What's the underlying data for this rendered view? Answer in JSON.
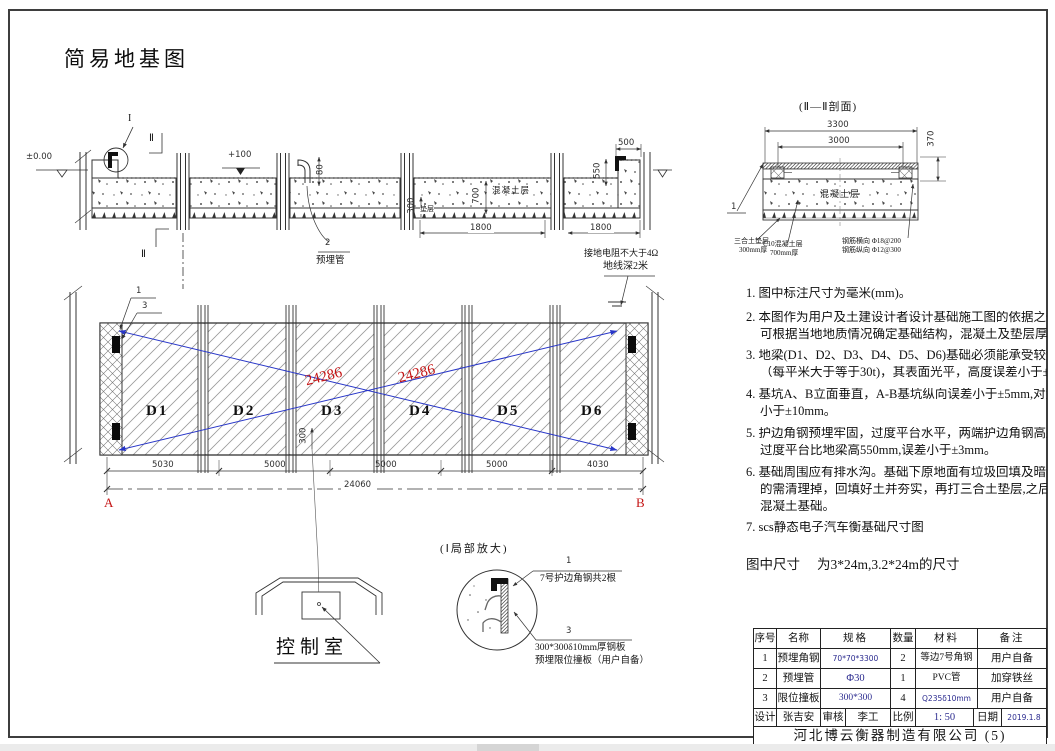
{
  "page": {
    "title": "简易地基图"
  },
  "colors": {
    "dimension_red": "#c41414",
    "diagonal_blue": "#2836c8",
    "spec_navy": "#2b2b8f",
    "line": "#333333"
  },
  "top_section": {
    "marker_i": "I",
    "marker_ii_top": "Ⅱ",
    "marker_ii_bottom": "Ⅱ",
    "level_zero": "±0.00",
    "level_plus100": "+100",
    "dim_pipe": "80",
    "callout_pipe_num": "2",
    "callout_pipe_label": "预埋管",
    "dim_depth": "700",
    "label_concrete": "混凝土层",
    "dim_cushion": "300",
    "label_cushion": "垫层",
    "dim_bay_a": "1800",
    "dim_bay_b": "1800",
    "dim_end_top": "500",
    "dim_end_side": "550",
    "ground_note_l1": "接地电阻不大于4Ω",
    "ground_note_l2": "地线深2米"
  },
  "section_ii": {
    "title": "(Ⅱ—Ⅱ剖面)",
    "dim_total": "3300",
    "dim_inner": "3000",
    "dim_height": "370",
    "callout_num": "1",
    "label_concrete": "混凝土层",
    "leader_cushion_l1": "三合土垫层",
    "leader_cushion_l2": "300mm厚",
    "leader_c10_l1": "C10混凝土层",
    "leader_c10_l2": "700mm厚",
    "leader_rebar_l1": "钢筋横向 Φ18@200",
    "leader_rebar_l2": "钢筋纵向 Φ12@300"
  },
  "plan": {
    "slabs": [
      "D1",
      "D2",
      "D3",
      "D4",
      "D5",
      "D6"
    ],
    "diag_a": "24286",
    "diag_b": "24286",
    "callout_1": "1",
    "callout_3": "3",
    "dim_small": "300",
    "seg_dims": [
      "5030",
      "5000",
      "5000",
      "5000",
      "4030"
    ],
    "dim_total": "24060",
    "corner_a": "A",
    "corner_b": "B"
  },
  "control_room": {
    "label": "控制室"
  },
  "detail_i": {
    "title": "(Ⅰ局部放大)",
    "callout_1": "1",
    "label_1": "7号护边角钢共2根",
    "callout_3": "3",
    "label_3_l1": "300*300δ10mm厚钢板",
    "label_3_l2": "预埋限位撞板（用户自备）"
  },
  "notes": {
    "n1": "1. 图中标注尺寸为毫米(mm)。",
    "n2_l1": "2. 本图作为用户及土建设计者设计基础施工图的依据之一，用户",
    "n2_l2": "可根据当地地质情况确定基础结构，混凝土及垫层厚度仅供参",
    "n3_l1": "3. 地梁(D1、D2、D3、D4、D5、D6)基础必须能承受较大的冲击和,",
    "n3_l2": "（每平米大于等于30t)，其表面光平，高度误差小于±3mm。",
    "n4_l1": "4. 基坑A、B立面垂直，A-B基坑纵向误差小于±5mm,对角线误差",
    "n4_l2": "小于±10mm。",
    "n5_l1": "5. 护边角钢预埋牢固，过度平台水平，两端护边角钢高度差<4mm",
    "n5_l2": "过度平台比地梁高550mm,误差小于±3mm。",
    "n6_l1": "6. 基础周围应有排水沟。基础下原地面有垃圾回填及暗沟、暗管",
    "n6_l2": "的需清理掉，回填好土并夯实，再打三合土垫层,之后再浇注",
    "n6_l3": "混凝土基础。",
    "n7": "7. scs静态电子汽车衡基础尺寸图",
    "size_label": "图中尺寸",
    "size_value": "为3*24m,3.2*24m的尺寸"
  },
  "bom": {
    "headers": [
      "序号",
      "名称",
      "规格",
      "数量",
      "材料",
      "备注"
    ],
    "rows": [
      [
        "1",
        "预埋角钢",
        "70*70*3300",
        "2",
        "等边7号角钢",
        "用户自备"
      ],
      [
        "2",
        "预埋管",
        "Φ30",
        "1",
        "PVC管",
        "加穿铁丝"
      ],
      [
        "3",
        "限位撞板",
        "300*300",
        "4",
        "Q235δ10mm",
        "用户自备"
      ]
    ],
    "footer": {
      "design_label": "设计",
      "design_value": "张吉安",
      "check_label": "审核",
      "check_value": "李工",
      "scale_label": "比例",
      "scale_value": "1: 50",
      "date_label": "日期",
      "date_value": "2019.1.8"
    },
    "company": "河北博云衡器制造有限公司 (5)"
  }
}
